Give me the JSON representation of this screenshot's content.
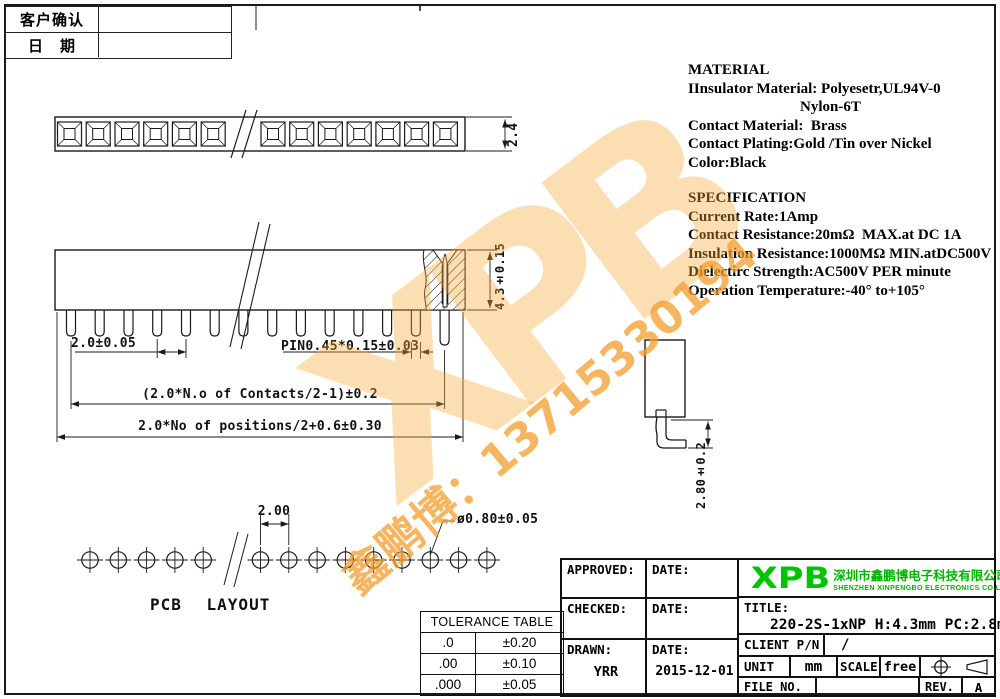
{
  "doc": {
    "confirm": {
      "row1": "客户确认",
      "row2": "日　期"
    },
    "material": {
      "title": "MATERIAL",
      "l1": "IInsulator Material: Polyesetr,UL94V-0",
      "l2": "Nylon-6T",
      "l3": "Contact Material:  Brass",
      "l4": "Contact Plating:Gold /Tin over Nickel",
      "l5": "Color:Black"
    },
    "spec": {
      "title": "SPECIFICATION",
      "l1": "Current Rate:1Amp",
      "l2": "Contact Resistance:20mΩ  MAX.at DC 1A",
      "l3": "Insulation Resistance:1000MΩ MIN.atDC500V",
      "l4": "Dielectirc Strength:AC500V PER minute",
      "l5": "Operation Temperature:-40° to+105°"
    },
    "dims": {
      "strip_width": "2.4",
      "housing_height": "4.3±0.15",
      "pin_pitch": "2.0±0.05",
      "pin_section": "PIN0.45*0.15±0.03",
      "contacts_span": "(2.0*N.o of Contacts/2-1)±0.2",
      "positions_span": "2.0*No of positions/2+0.6±0.30",
      "pcb_pitch": "2.00",
      "pcb_hole_dia": "ø0.80±0.05",
      "tail_below": "2.80±0.2"
    },
    "pcb_label": "PCB LAYOUT",
    "tol": {
      "title": "TOLERANCE TABLE",
      "r1c1": ".0",
      "r1c2": "±0.20",
      "r2c1": ".00",
      "r2c2": "±0.10",
      "r3c1": ".000",
      "r3c2": "±0.05"
    },
    "tb": {
      "approved": "APPROVED:",
      "date1": "DATE:",
      "checked": "CHECKED:",
      "date2": "DATE:",
      "drawn": "DRAWN:",
      "drawn_name": "YRR",
      "date3": "DATE:",
      "drawn_date": "2015-12-01",
      "logo": "XPB",
      "company_cn": "深圳市鑫鹏博电子科技有限公司",
      "company_en": "SHENZHEN XINPENGBO ELECTRONICS CO.LTD",
      "title_label": "TITLE:",
      "title_value": "220-2S-1xNP H:4.3mm PC:2.8mm",
      "client_label": "CLIENT P/N",
      "client_value": "/",
      "unit_label": "UNIT",
      "unit_value": "mm",
      "scale_label": "SCALE",
      "scale_value": "free",
      "file_label": "FILE NO.",
      "rev_label": "REV.",
      "rev_value": "A"
    },
    "watermark": {
      "logo": "XPB",
      "line": "鑫鹏博：13715330194"
    },
    "colors": {
      "logo_green": "#00c400",
      "watermark_orange": "#f5a838"
    }
  }
}
